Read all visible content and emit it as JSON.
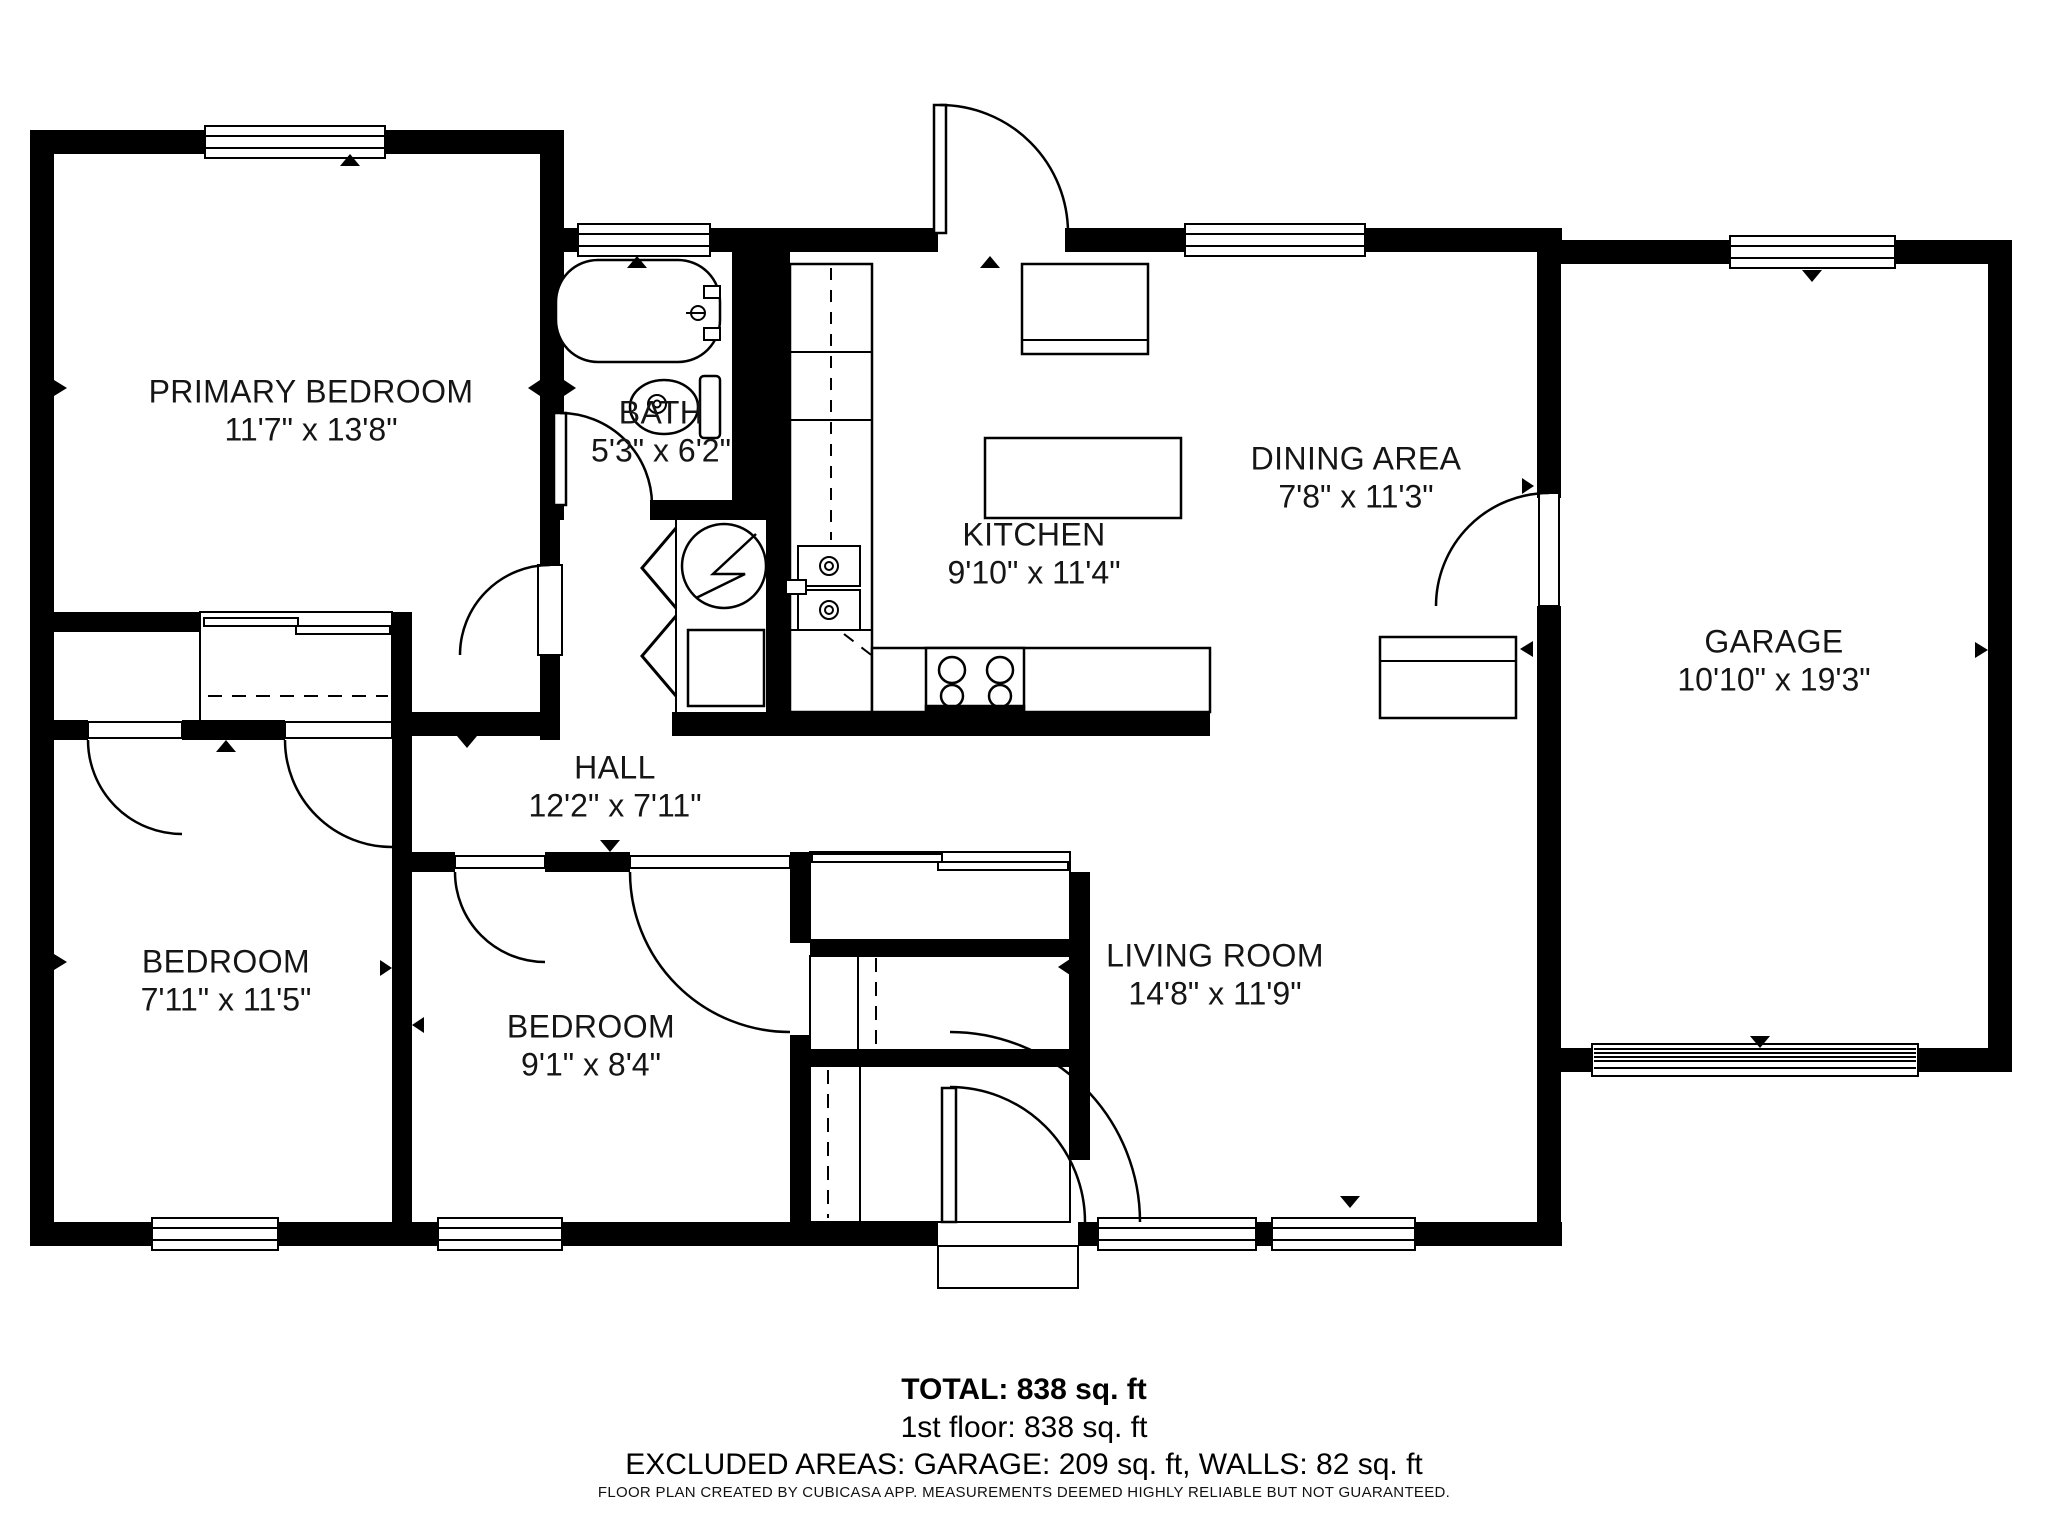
{
  "rooms": {
    "primary_bedroom": {
      "name": "PRIMARY BEDROOM",
      "dims": "11'7\" x 13'8\""
    },
    "bath": {
      "name": "BATH",
      "dims": "5'3\" x 6'2\""
    },
    "kitchen": {
      "name": "KITCHEN",
      "dims": "9'10\" x 11'4\""
    },
    "dining_area": {
      "name": "DINING AREA",
      "dims": "7'8\" x 11'3\""
    },
    "garage": {
      "name": "GARAGE",
      "dims": "10'10\" x 19'3\""
    },
    "hall": {
      "name": "HALL",
      "dims": "12'2\" x 7'11\""
    },
    "bedroom_left": {
      "name": "BEDROOM",
      "dims": "7'11\" x 11'5\""
    },
    "bedroom_middle": {
      "name": "BEDROOM",
      "dims": "9'1\" x 8'4\""
    },
    "living_room": {
      "name": "LIVING ROOM",
      "dims": "14'8\" x 11'9\""
    }
  },
  "summary": {
    "total": "TOTAL: 838 sq. ft",
    "first_floor": "1st floor: 838 sq. ft",
    "excluded": "EXCLUDED AREAS: GARAGE: 209 sq. ft, WALLS: 82 sq. ft"
  },
  "footer_note": "FLOOR PLAN CREATED BY CUBICASA APP. MEASUREMENTS DEEMED HIGHLY RELIABLE BUT NOT GUARANTEED.",
  "colors": {
    "wall": "#000000",
    "background": "#ffffff",
    "text": "#151515"
  }
}
